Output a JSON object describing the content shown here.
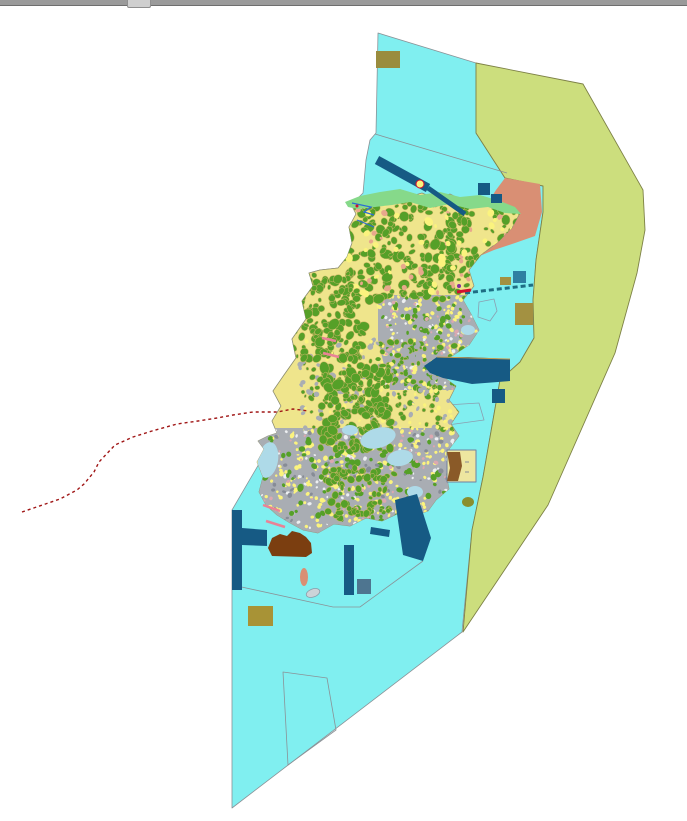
{
  "window": {
    "topbar": {
      "bar_color": "#9a9a9a",
      "thumb_color": "#cfcfcf",
      "thumb_x": 127
    }
  },
  "map": {
    "description_name": "coastal-land-use-gis-map",
    "canvas": {
      "width": 687,
      "height": 815,
      "background": "#ffffff"
    },
    "colors": {
      "sea": "#80EFF0",
      "seaLine": "#8A9297",
      "zone": "#CCDE7D",
      "zoneLine": "#7D8146",
      "islandBase": "#EFE58C",
      "islandLine": "#8F8F70",
      "forest": "#55A028",
      "forestLine": "#C9B565",
      "tan": "#C8A050",
      "brightYellow": "#FBF37E",
      "salmon": "#D98F74",
      "salmonSoft": "#E8A88C",
      "urban": "#A9ADB3",
      "urbanDark": "#878C96",
      "white": "#EDEFF1",
      "pinkSpeck": "#DCA8B0",
      "navy": "#165A84",
      "teal": "#1E6E84",
      "tealSquare": "#2E7FA2",
      "steel": "#4E7590",
      "brown": "#7B3E10",
      "brownDark": "#8A5A28",
      "khaki": "#A39141",
      "khakiDark": "#9A8C3E",
      "khakiBottom": "#A89336",
      "olive": "#8A8F2E",
      "paleBlue": "#AEDAE8",
      "grayOval": "#CDD3D8",
      "grayOvalLine": "#8A9AA8",
      "routeRed": "#A01616",
      "pink": "#E98396",
      "stream": "#2B6BD4",
      "crimson": "#D01030",
      "purple": "#8030A0",
      "paleYellow": "#EDE6A0",
      "rectOutline": "#7080A0",
      "outlineBlue": "#8A9FB0",
      "none": "none"
    },
    "features": [
      {
        "k": "poly",
        "n": "sea-region",
        "f": "sea",
        "s": "seaLine",
        "w": 0.8,
        "p": "378,27 476,57 476,127 505,172 543,180 543,206 536,254 533,294 534,332 520,356 500,374 483,471 472,524 462,626 232,802 232,504 277,427 272,415 281,400 273,385 284,369 296,352 292,333 306,313 302,295 313,280 309,267 320,264 338,262 347,251 352,237 349,221 356,208 352,200 358,192 363,187 366,154 370,134 376,127"
      },
      {
        "k": "poly",
        "n": "offshore-boundary-zone",
        "f": "zone",
        "s": "zoneLine",
        "w": 0.9,
        "p": "476,57 583,78 643,184 645,224 637,267 615,347 548,499 463,626 472,524 483,471 500,374 520,356 534,332 533,294 536,254 543,206 543,180 505,172 476,127"
      },
      {
        "k": "pline",
        "n": "sea-parcel-boundary-north",
        "s": "seaLine",
        "w": 0.8,
        "p": "375,128 507,167"
      },
      {
        "k": "pline",
        "n": "sea-parcel-boundary-south",
        "s": "seaLine",
        "w": 0.8,
        "p": "237,580 333,601 360,601 423,555"
      },
      {
        "k": "poly",
        "n": "sea-parcel-outline-trapezoid",
        "f": "none",
        "s": "seaLine",
        "w": 0.8,
        "p": "283,666 327,672 336,724 288,759"
      },
      {
        "k": "poly",
        "n": "aquaculture-outline-quad",
        "f": "none",
        "s": "outlineBlue",
        "w": 0.8,
        "p": "430,400 479,397 484,414 433,421"
      },
      {
        "k": "poly",
        "n": "aquaculture-outline-pentagon-east",
        "f": "none",
        "s": "outlineBlue",
        "w": 0.8,
        "p": "479,296 494,293 497,305 490,315 478,311"
      },
      {
        "k": "poly",
        "n": "aquaculture-outline-pentagon-south",
        "f": "none",
        "s": "outlineBlue",
        "w": 0.8,
        "p": "420,464 436,462 439,476 430,486 419,482"
      },
      {
        "k": "poly",
        "n": "reclaimed-land-salmon-area",
        "f": "salmon",
        "s": "none",
        "w": 0,
        "p": "505,172 540,178 542,206 535,230 515,237 494,244 470,254 448,248 441,241 456,230 473,216 486,200 496,184"
      },
      {
        "k": "island",
        "n": "island-landmass",
        "f": "islandBase",
        "s": "islandLine",
        "w": 0.7,
        "p": "358,192 370,197 382,190 395,186 408,191 422,187 436,193 450,188 462,194 475,191 488,197 500,195 510,201 520,207 512,222 498,236 481,249 469,264 474,280 463,294 471,308 479,324 469,339 452,350 434,357 442,370 456,380 449,394 459,406 451,418 459,430 449,443 455,455 446,468 449,483 436,494 428,505 413,510 397,508 382,515 366,512 350,520 334,518 318,527 303,524 290,517 277,509 266,499 259,486 263,471 257,456 264,443 258,435 268,430 277,427 272,415 281,400 273,385 284,369 296,352 292,333 306,313 302,295 313,280 309,267 320,264 338,262 347,251 352,237 349,221 356,208 352,200"
      },
      {
        "k": "poly",
        "n": "coastal-green-strip",
        "f": "forestStrip",
        "s": "none",
        "w": 0,
        "p": "345,196 360,190 380,186 400,183 420,189 440,186 460,191 480,189 500,195 515,201 521,208 505,207 488,201 470,203 450,198 430,202 410,196 392,199 375,201 358,203 348,201"
      },
      {
        "k": "band",
        "n": "harbor-breakwater-north",
        "s": "navy",
        "w": 9,
        "p": "377,154 428,182"
      },
      {
        "k": "band",
        "n": "harbor-breakwater-north-tip",
        "s": "navy",
        "w": 5,
        "p": "428,182 465,208"
      },
      {
        "k": "rect",
        "n": "marine-block-a",
        "f": "navy",
        "p": "478,177,12,12"
      },
      {
        "k": "rect",
        "n": "marine-block-b",
        "f": "navy",
        "p": "491,188,11,9"
      },
      {
        "k": "rect",
        "n": "marine-block-teal",
        "f": "tealSquare",
        "p": "513,265,13,12"
      },
      {
        "k": "rect",
        "n": "marine-block-khaki-small",
        "f": "khaki",
        "p": "500,271,11,8"
      },
      {
        "k": "pline",
        "n": "submarine-cable-dashed-line",
        "s": "teal",
        "w": 3,
        "d": "5,3",
        "p": "465,287 533,279"
      },
      {
        "k": "poly",
        "n": "port-quay-east",
        "f": "navy",
        "s": "none",
        "w": 0,
        "p": "424,360 437,351 468,351 510,353 510,375 472,378 443,372 430,367"
      },
      {
        "k": "pline",
        "n": "port-quay-edge-line",
        "s": "tan",
        "w": 1,
        "p": "437,351 510,353"
      },
      {
        "k": "rect",
        "n": "port-basin-square",
        "f": "navy",
        "p": "492,383,13,14"
      },
      {
        "k": "rect",
        "n": "khaki-field-east",
        "f": "khaki",
        "p": "515,297,18,22"
      },
      {
        "k": "poly",
        "n": "south-breakwater-band",
        "f": "navy",
        "s": "none",
        "w": 0,
        "p": "395,494 417,488 431,532 423,555 403,549"
      },
      {
        "k": "poly",
        "n": "south-coast-jetty",
        "f": "navy",
        "s": "none",
        "w": 0,
        "p": "371,521 390,524 389,531 370,528"
      },
      {
        "k": "rect",
        "n": "south-pier-vertical",
        "f": "navy",
        "p": "344,539,10,50"
      },
      {
        "k": "rect",
        "n": "steel-block-square",
        "f": "steel",
        "p": "357,573,14,15"
      },
      {
        "k": "poly",
        "n": "west-t-pier",
        "f": "navy",
        "s": "none",
        "w": 0,
        "p": "232,504 242,504 242,522 267,524 267,540 242,539 242,584 232,584"
      },
      {
        "k": "poly",
        "n": "brown-tidal-flat",
        "f": "brown",
        "s": "none",
        "w": 0,
        "p": "268,542 272,532 280,528 287,530 292,525 300,527 306,531 311,537 312,547 306,551 272,550"
      },
      {
        "k": "ell",
        "n": "salmon-islet",
        "f": "salmon",
        "p": "304,571,4,9,0"
      },
      {
        "k": "ell",
        "n": "gray-islet-oval",
        "f": "grayOval",
        "s": "grayOvalLine",
        "w": 0.8,
        "p": "313,587,7,4,-20"
      },
      {
        "k": "rect",
        "n": "khaki-field-south",
        "f": "khakiBottom",
        "p": "248,600,25,20"
      },
      {
        "k": "ell",
        "n": "olive-islet",
        "f": "olive",
        "p": "468,496,6,5,0"
      },
      {
        "k": "rect",
        "n": "khaki-field-north",
        "f": "khakiDark",
        "p": "376,45,24,17"
      },
      {
        "k": "poly",
        "n": "survey-plot-rect",
        "f": "paleYellow",
        "s": "rectOutline",
        "w": 1,
        "p": "447,444 476,444 476,476 447,476"
      },
      {
        "k": "poly",
        "n": "survey-plot-brown-part",
        "f": "brownDark",
        "s": "none",
        "w": 0,
        "p": "447,446 460,446 462,460 458,475 447,475 450,462"
      },
      {
        "k": "pline",
        "n": "survey-plot-mark-a",
        "s": "urbanDark",
        "w": 1,
        "p": "465,456 469,456"
      },
      {
        "k": "pline",
        "n": "survey-plot-mark-b",
        "s": "urbanDark",
        "w": 1,
        "p": "465,466 469,466"
      },
      {
        "k": "pline",
        "n": "stream-north-a",
        "s": "stream",
        "w": 1.2,
        "p": "352,197 371,201 364,206 374,209"
      },
      {
        "k": "pline",
        "n": "stream-north-b",
        "s": "stream",
        "w": 1,
        "p": "357,214 374,221"
      },
      {
        "k": "circ",
        "n": "lighthouse-marker",
        "f": "brightYellow",
        "s": "crimson",
        "w": 1,
        "p": "420,178,4"
      },
      {
        "k": "circ",
        "n": "coast-red-dot",
        "f": "crimson",
        "p": "357,200,1.5"
      },
      {
        "k": "pline",
        "n": "ferry-port-red-mark",
        "s": "crimson",
        "w": 3,
        "p": "457,286 471,284"
      },
      {
        "k": "circ",
        "n": "ferry-port-purple-dot",
        "f": "purple",
        "p": "459,280,2"
      },
      {
        "k": "pline",
        "n": "ferry-route-dashed-line",
        "s": "routeRed",
        "w": 1.4,
        "d": "3,3",
        "p": "22,506 60,493 77,484 84,478 94,466 99,456 115,439 133,431 152,425 177,418 198,415 217,412 233,409 253,406 277,406 293,403 309,405"
      },
      {
        "k": "pline",
        "n": "pink-groyne-a",
        "s": "pink",
        "w": 2.5,
        "p": "322,332 336,335"
      },
      {
        "k": "pline",
        "n": "pink-groyne-b",
        "s": "pink",
        "w": 2.5,
        "p": "323,347 339,351"
      },
      {
        "k": "pline",
        "n": "pink-groyne-c",
        "s": "pink",
        "w": 2.5,
        "p": "263,499 280,505"
      },
      {
        "k": "pline",
        "n": "pink-groyne-d",
        "s": "pink",
        "w": 2.5,
        "p": "266,515 285,521"
      }
    ],
    "texture": {
      "seed": 20240711,
      "strip_color_key": "forestStrip",
      "strip_hex": "#86D98A",
      "zones": [
        {
          "n": "urban-texture-east",
          "poly": "378,289 480,289 480,384 390,384 378,334",
          "base": "urban",
          "blobs": [
            {
              "c": "brightYellow",
              "count": 150,
              "rmin": 1,
              "rmax": 2.5
            },
            {
              "c": "white",
              "count": 55,
              "rmin": 1,
              "rmax": 2
            },
            {
              "c": "forest",
              "count": 85,
              "rmin": 1.5,
              "rmax": 3
            },
            {
              "c": "pinkSpeck",
              "count": 38,
              "rmin": 1,
              "rmax": 2
            }
          ]
        },
        {
          "n": "urban-texture-south",
          "poly": "252,422 460,422 445,514 300,534 255,499",
          "base": "urban",
          "blobs": [
            {
              "c": "brightYellow",
              "count": 250,
              "rmin": 1,
              "rmax": 2.5
            },
            {
              "c": "white",
              "count": 80,
              "rmin": 1,
              "rmax": 2.2
            },
            {
              "c": "forest",
              "count": 135,
              "rmin": 1.5,
              "rmax": 3.5
            },
            {
              "c": "pinkSpeck",
              "count": 48,
              "rmin": 1,
              "rmax": 2
            },
            {
              "c": "urbanDark",
              "count": 60,
              "rmin": 1.2,
              "rmax": 2.5
            }
          ]
        },
        {
          "n": "mixed-texture-middle",
          "poly": "300,334 470,334 470,424 300,424",
          "base": null,
          "blobs": [
            {
              "c": "forest",
              "count": 150,
              "rmin": 1.5,
              "rmax": 3,
              "stroke": "forestLine"
            },
            {
              "c": "urban",
              "count": 120,
              "rmin": 1.5,
              "rmax": 3
            },
            {
              "c": "brightYellow",
              "count": 80,
              "rmin": 1,
              "rmax": 2.5
            }
          ]
        },
        {
          "n": "forest-texture-north",
          "poly": "340,189 525,189 520,294 420,294 370,289 340,264",
          "base": null,
          "blobs": [
            {
              "c": "forest",
              "count": 330,
              "rmin": 2,
              "rmax": 5,
              "stroke": "forestLine"
            },
            {
              "c": "salmonSoft",
              "count": 45,
              "rmin": 1.5,
              "rmax": 3
            },
            {
              "c": "brightYellow",
              "count": 50,
              "rmin": 2,
              "rmax": 4
            }
          ]
        },
        {
          "n": "forest-texture-west",
          "poly": "293,274 360,269 365,354 298,354",
          "base": null,
          "blobs": [
            {
              "c": "forest",
              "count": 140,
              "rmin": 2,
              "rmax": 5,
              "stroke": "forestLine"
            }
          ]
        },
        {
          "n": "forest-texture-central",
          "poly": "320,359 390,359 392,444 322,444",
          "base": null,
          "blobs": [
            {
              "c": "forest",
              "count": 160,
              "rmin": 2,
              "rmax": 5.5,
              "stroke": "forestLine"
            }
          ]
        },
        {
          "n": "forest-texture-south-patch",
          "poly": "325,464 395,462 390,509 330,514",
          "base": null,
          "blobs": [
            {
              "c": "forest",
              "count": 70,
              "rmin": 2,
              "rmax": 4,
              "stroke": "forestLine"
            }
          ]
        }
      ],
      "inlets": [
        {
          "n": "tidal-inlet-a",
          "p": "378,432,18,10,-15"
        },
        {
          "n": "tidal-inlet-b",
          "p": "400,452,13,8,-10"
        },
        {
          "n": "tidal-inlet-west",
          "p": "268,454,10,18,10"
        },
        {
          "n": "tidal-inlet-c",
          "p": "415,486,8,6,0"
        },
        {
          "n": "tidal-inlet-d",
          "p": "350,424,8,5,0"
        },
        {
          "n": "tidal-cove-ne-a",
          "p": "475,294,8,6,0"
        },
        {
          "n": "tidal-cove-ne-b",
          "p": "468,324,7,5,0"
        }
      ],
      "inlet_color": "paleBlue"
    }
  }
}
